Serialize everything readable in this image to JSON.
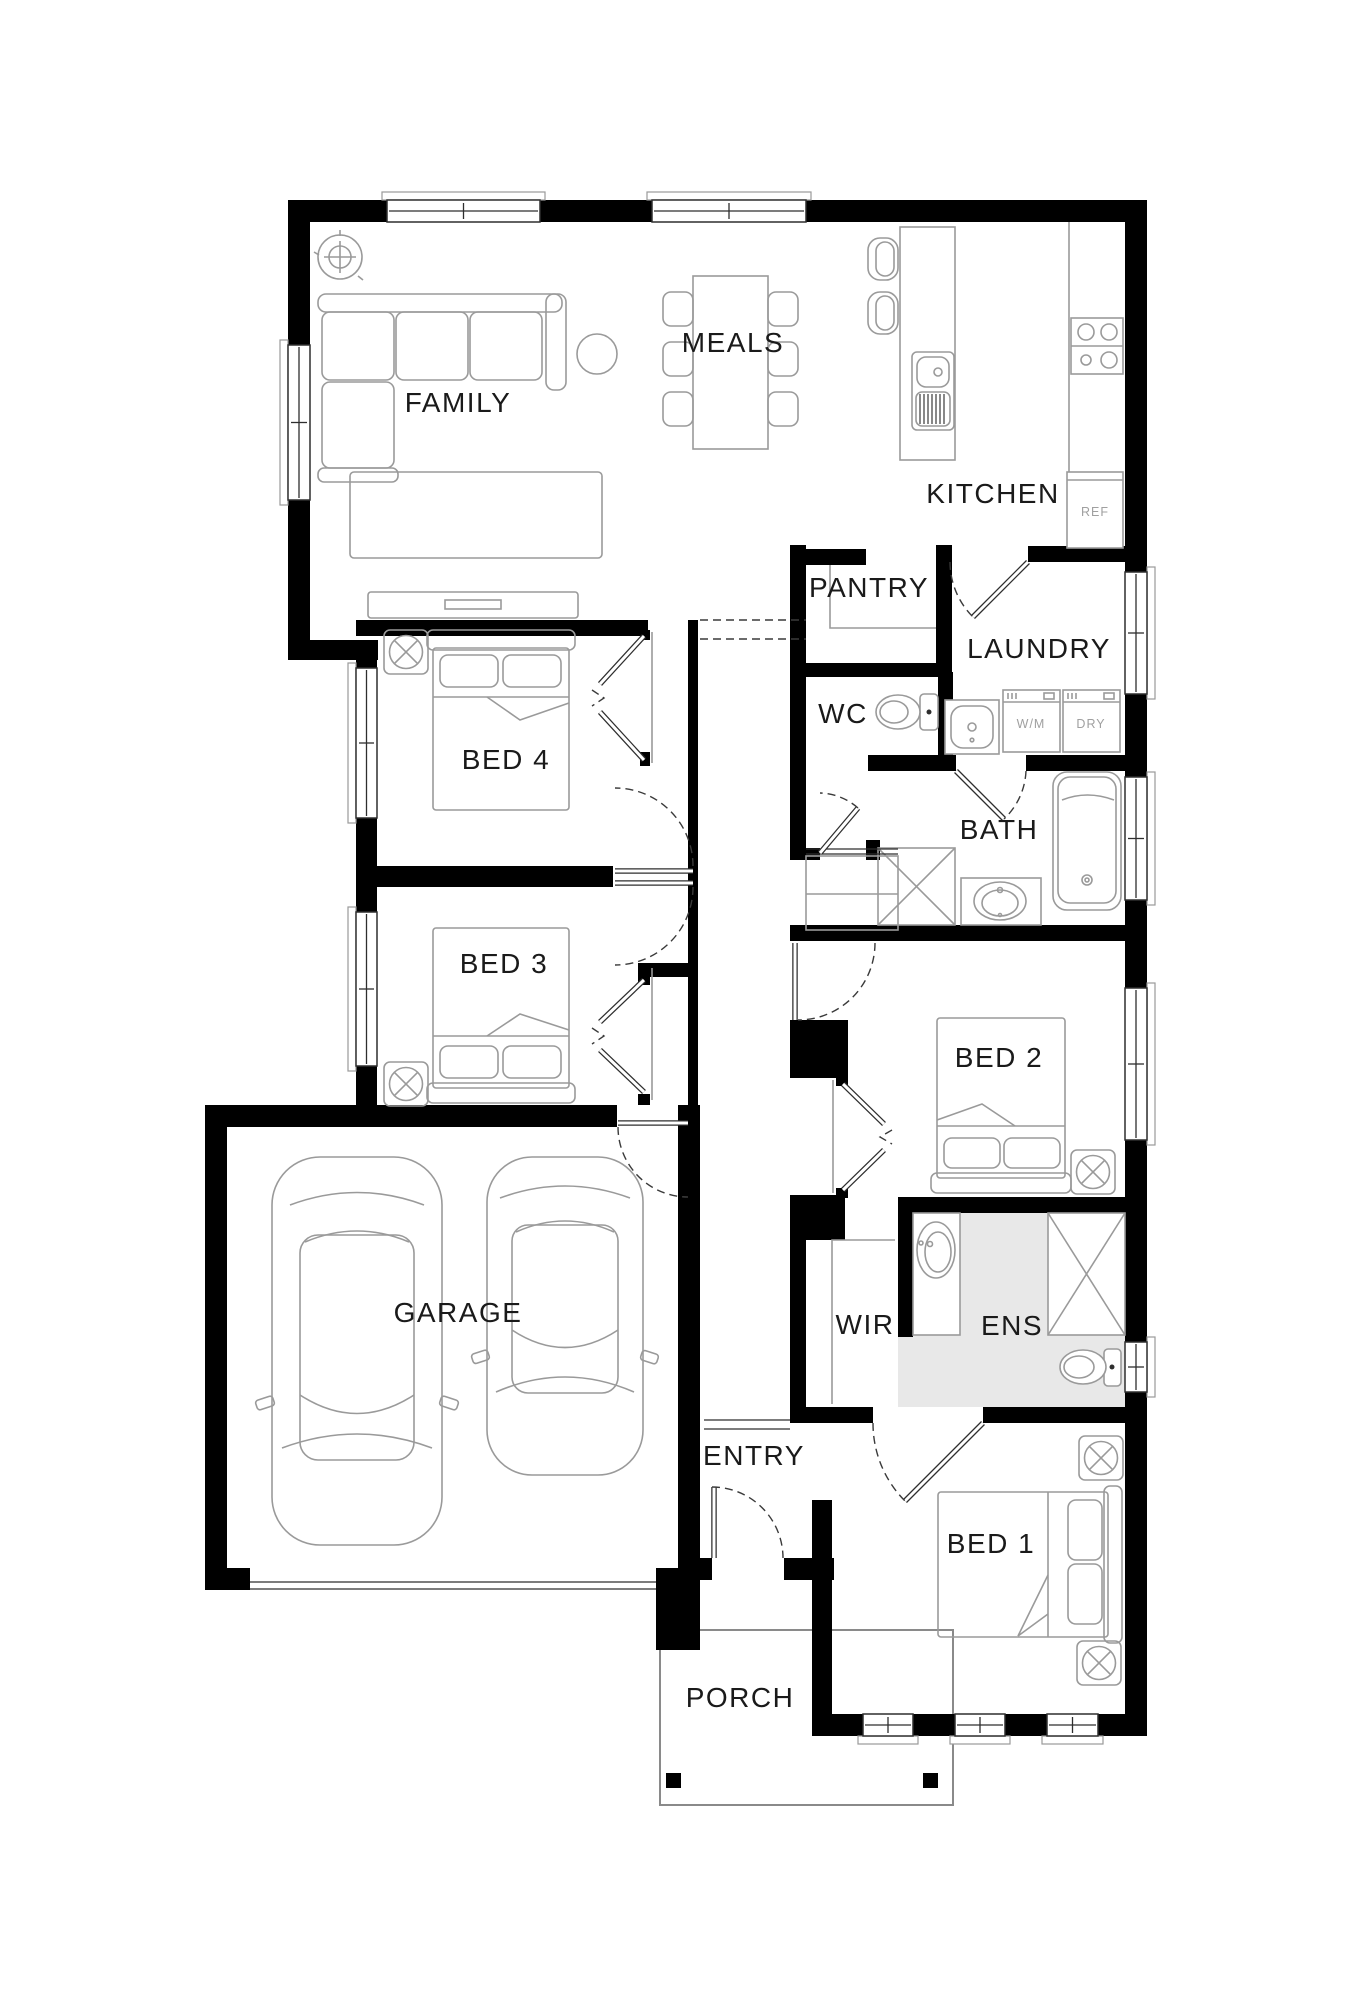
{
  "plan": {
    "rooms": {
      "family": "FAMILY",
      "meals": "MEALS",
      "kitchen": "KITCHEN",
      "pantry": "PANTRY",
      "laundry": "LAUNDRY",
      "wc": "WC",
      "bed4": "BED 4",
      "bath": "BATH",
      "bed3": "BED 3",
      "bed2": "BED 2",
      "garage": "GARAGE",
      "wir": "WIR",
      "ens": "ENS",
      "entry": "ENTRY",
      "bed1": "BED 1",
      "porch": "PORCH"
    },
    "appliances": {
      "fridge": "REF",
      "washing_machine": "W/M",
      "dryer": "DRY"
    },
    "colors": {
      "wall": "#000000",
      "furniture_line": "#9a9a9a",
      "door_line": "#3a3a3a",
      "ens_floor": "#e8e8e8",
      "room_label": "#1a1a1a",
      "appliance_label": "#a0a0a0",
      "background": "#ffffff"
    }
  }
}
